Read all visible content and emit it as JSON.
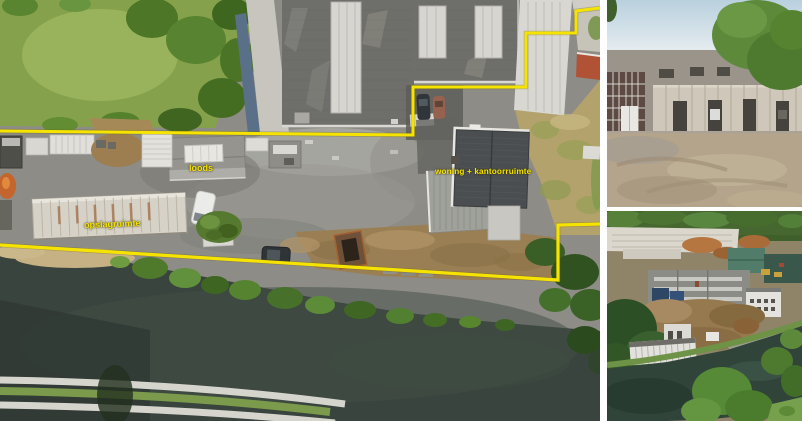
{
  "colors": {
    "boundary_yellow": "#f6e400",
    "label_yellow": "#f6e400",
    "page_bg": "#ffffff"
  },
  "gallery": {
    "main_photo": {
      "kind": "aerial-top-down-site-photo-with-property-boundary",
      "annotations": {
        "loods": "loods",
        "woning_kantoor": "woning + kantoorruimte",
        "opslagruimte": "opslagruimte"
      }
    },
    "side_photos": {
      "top": {
        "kind": "facade-photo-concrete-business-building"
      },
      "bottom": {
        "kind": "aerial-photo-industrial-site-along-river"
      }
    }
  }
}
